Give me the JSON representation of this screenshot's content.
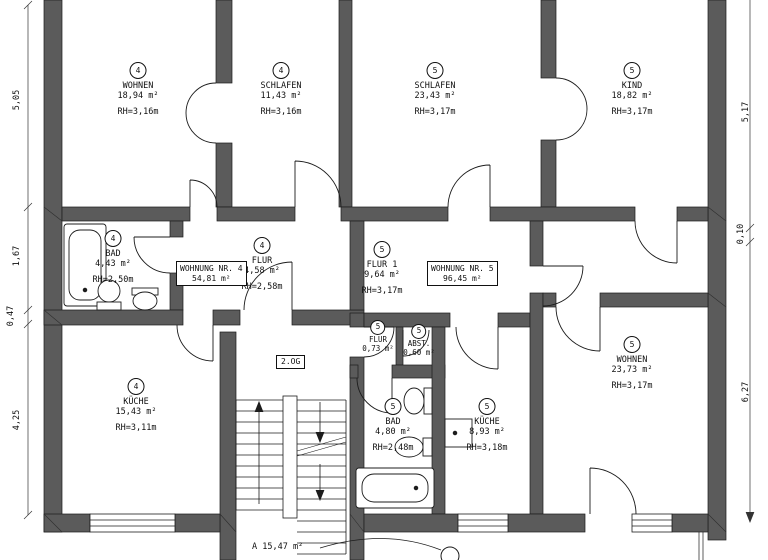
{
  "drawing_title": "Grundriss 2. Obergeschoss",
  "floor_label": "2.OG",
  "apartment_boxes": [
    {
      "name": "WOHNUNG NR. 4",
      "area": "54,81 m²"
    },
    {
      "name": "WOHNUNG NR. 5",
      "area": "96,45 m²"
    }
  ],
  "rooms": [
    {
      "id": "wohnen-4",
      "number": "4",
      "name": "WOHNEN",
      "area": "18,94 m²",
      "rh": "RH=3,16m"
    },
    {
      "id": "schlafen-4",
      "number": "4",
      "name": "SCHLAFEN",
      "area": "11,43 m²",
      "rh": "RH=3,16m"
    },
    {
      "id": "schlafen-5",
      "number": "5",
      "name": "SCHLAFEN",
      "area": "23,43 m²",
      "rh": "RH=3,17m"
    },
    {
      "id": "kind-5",
      "number": "5",
      "name": "KIND",
      "area": "18,82 m²",
      "rh": "RH=3,17m"
    },
    {
      "id": "bad-4",
      "number": "4",
      "name": "BAD",
      "area": "4,43 m²",
      "rh": "RH=2,50m"
    },
    {
      "id": "flur-4",
      "number": "4",
      "name": "FLUR",
      "area": "4,58 m²",
      "rh": "RH=2,58m"
    },
    {
      "id": "flur1-5",
      "number": "5",
      "name": "FLUR 1",
      "area": "9,64 m²",
      "rh": "RH=3,17m"
    },
    {
      "id": "flur-5",
      "number": "5",
      "name": "FLUR",
      "area": "0,73 m²",
      "rh": ""
    },
    {
      "id": "abst-5",
      "number": "5",
      "name": "ABST.",
      "area": "0,60 m²",
      "rh": ""
    },
    {
      "id": "kueche-4",
      "number": "4",
      "name": "KÜCHE",
      "area": "15,43 m²",
      "rh": "RH=3,11m"
    },
    {
      "id": "bad-5",
      "number": "5",
      "name": "BAD",
      "area": "4,80 m²",
      "rh": "RH=2,48m"
    },
    {
      "id": "kueche-5",
      "number": "5",
      "name": "KÜCHE",
      "area": "8,93 m²",
      "rh": "RH=3,18m"
    },
    {
      "id": "wohnen-5",
      "number": "5",
      "name": "WOHNEN",
      "area": "23,73 m²",
      "rh": "RH=3,17m"
    }
  ],
  "stairwell_label": "A 15,47 m²",
  "dimensions": {
    "left": [
      "5,05",
      "1,67",
      "0,47",
      "4,25"
    ],
    "right": [
      "5,17",
      "0,10",
      "6,27"
    ]
  },
  "colors": {
    "wall": "#5b5b5b",
    "line": "#1c1c1c",
    "background": "#ffffff"
  }
}
